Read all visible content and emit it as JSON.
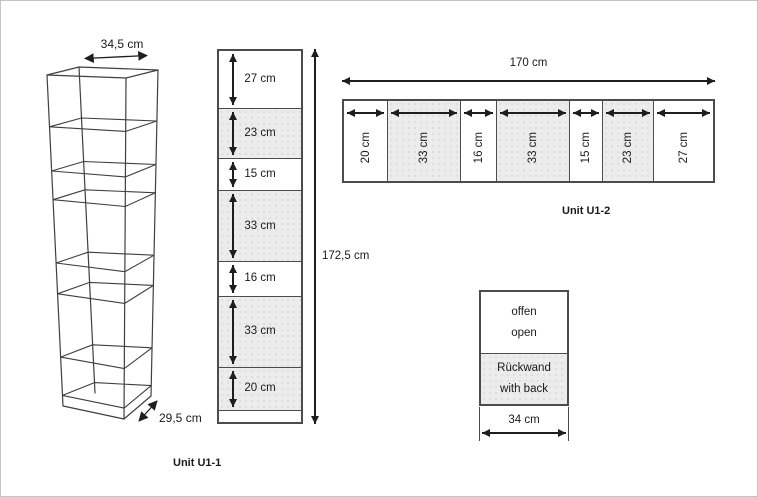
{
  "figure": {
    "iso_view": {
      "width_label": "34,5 cm",
      "depth_label": "29,5 cm"
    },
    "unit_u1_1": {
      "caption": "Unit U1-1",
      "total_label": "172,5 cm",
      "sections": [
        {
          "label": "27 cm",
          "size": 27,
          "type": "open"
        },
        {
          "label": "23 cm",
          "size": 23,
          "type": "back"
        },
        {
          "label": "15 cm",
          "size": 15,
          "type": "open"
        },
        {
          "label": "33 cm",
          "size": 33,
          "type": "back"
        },
        {
          "label": "16 cm",
          "size": 16,
          "type": "open"
        },
        {
          "label": "33 cm",
          "size": 33,
          "type": "back"
        },
        {
          "label": "20 cm",
          "size": 20,
          "type": "back"
        }
      ]
    },
    "unit_u1_2": {
      "caption": "Unit U1-2",
      "total_label": "170 cm",
      "sections": [
        {
          "label": "20 cm",
          "size": 20,
          "type": "open"
        },
        {
          "label": "33 cm",
          "size": 33,
          "type": "back"
        },
        {
          "label": "16 cm",
          "size": 16,
          "type": "open"
        },
        {
          "label": "33 cm",
          "size": 33,
          "type": "back"
        },
        {
          "label": "15 cm",
          "size": 15,
          "type": "open"
        },
        {
          "label": "23 cm",
          "size": 23,
          "type": "back"
        },
        {
          "label": "27 cm",
          "size": 27,
          "type": "open"
        }
      ]
    },
    "legend": {
      "open_label_de": "offen",
      "open_label_en": "open",
      "back_label_de": "Rückwand",
      "back_label_en": "with back",
      "width_label": "34 cm"
    },
    "colors": {
      "line": "#4c4c4c",
      "back_fill": "#ececec"
    }
  }
}
